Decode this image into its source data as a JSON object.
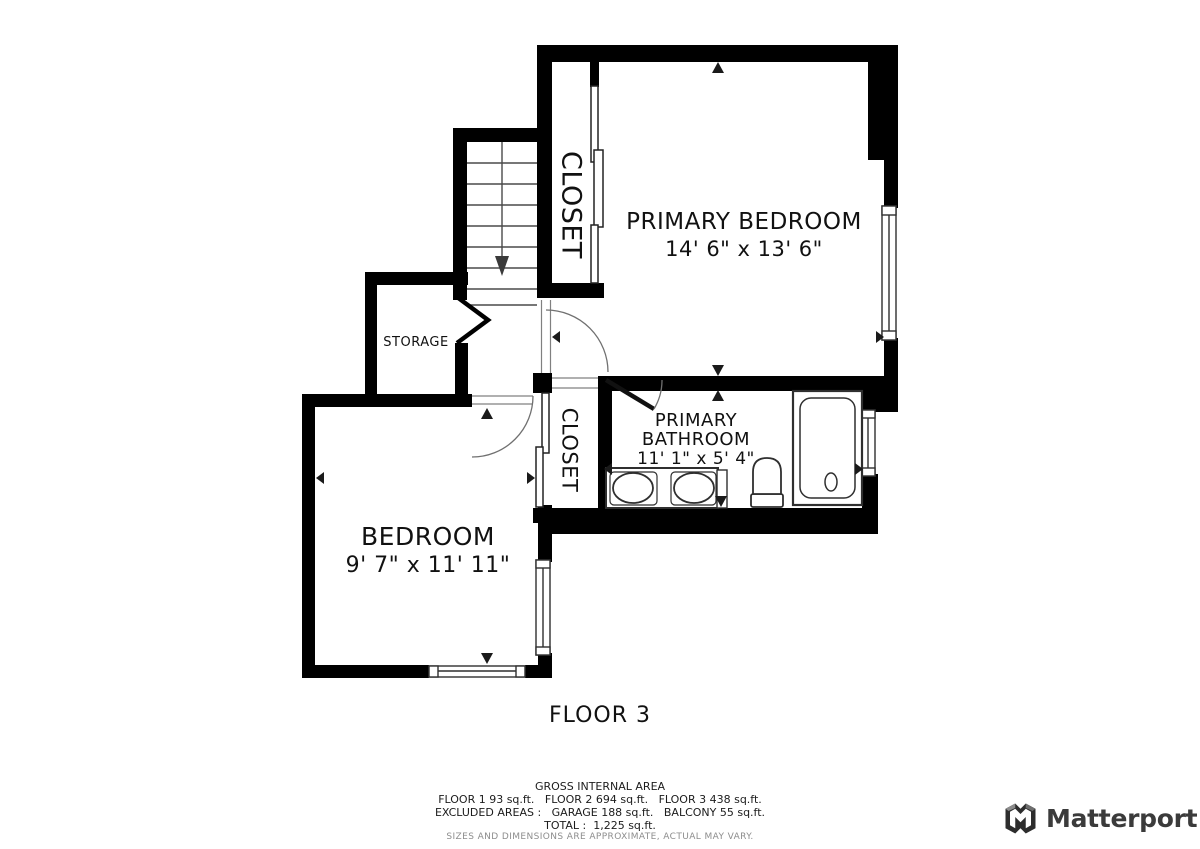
{
  "floor_plan": {
    "floor_label": "FLOOR 3",
    "rooms": {
      "primary_bedroom": {
        "name": "PRIMARY BEDROOM",
        "dimensions": "14' 6\" x 13' 6\""
      },
      "closet_upper": {
        "name": "CLOSET"
      },
      "closet_lower": {
        "name": "CLOSET"
      },
      "storage": {
        "name": "STORAGE"
      },
      "primary_bathroom": {
        "name_line1": "PRIMARY",
        "name_line2": "BATHROOM",
        "dimensions": "11' 1\" x 5' 4\""
      },
      "bedroom": {
        "name": "BEDROOM",
        "dimensions": "9' 7\" x 11' 11\""
      }
    }
  },
  "area_summary": {
    "title": "GROSS INTERNAL AREA",
    "line1": "FLOOR 1 93 sq.ft.   FLOOR 2 694 sq.ft.   FLOOR 3 438 sq.ft.",
    "line2": "EXCLUDED AREAS :   GARAGE 188 sq.ft.   BALCONY 55 sq.ft.",
    "line3": "TOTAL :  1,225 sq.ft.",
    "disclaimer": "SIZES AND DIMENSIONS ARE APPROXIMATE, ACTUAL MAY VARY."
  },
  "branding": {
    "logo_text": "Matterport"
  },
  "colors": {
    "wall": "#000000",
    "background": "#ffffff",
    "thin_line": "#3a3a3a",
    "arc_line": "#707070",
    "fixture_line": "#2f2f2f",
    "disclaimer_text": "#8d8d8d",
    "logo_text": "#3b3b3b"
  }
}
